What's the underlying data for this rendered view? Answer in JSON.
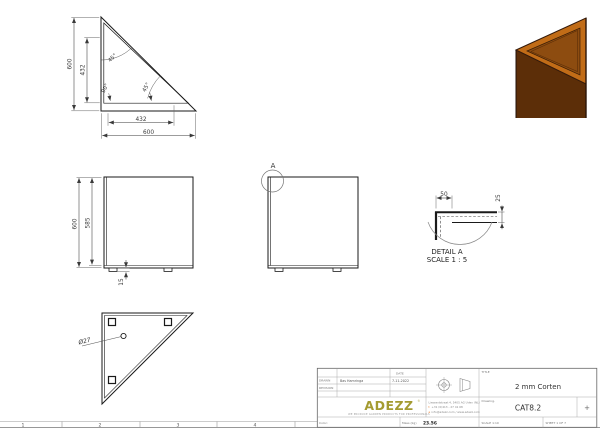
{
  "sheet": {
    "background": "#ffffff",
    "zones": [
      "1",
      "2",
      "3",
      "4"
    ]
  },
  "views": {
    "front": {
      "height": "600",
      "inner_height": "432",
      "inner_width": "432",
      "width": "600",
      "angle_top": "45°",
      "angle_corner": "90°",
      "angle_hyp": "45°"
    },
    "side_a": {
      "height": "600",
      "inner_height": "585",
      "foot_height": "15"
    },
    "side_b": {
      "detail_ref": "A"
    },
    "detail_a": {
      "title": "DETAIL A",
      "scale": "SCALE 1 : 5",
      "flange_width": "50",
      "flange_height": "25"
    },
    "bottom": {
      "hole_diameter": "Ø27"
    }
  },
  "render_3d": {
    "rim_color": "#c16c17",
    "top_color": "#8d4c10",
    "front_color": "#5c2e08",
    "outline_color": "#33190a"
  },
  "title_block": {
    "drawn_label": "DRAWN",
    "drawn_value": "Bas Hamringa",
    "revision_label": "REVISION",
    "date_label": "DATE",
    "date_value": "7-11-2022",
    "title_label": "TITLE",
    "title_value": "2 mm Corten",
    "drawing_label": "Drawing.",
    "drawing_value": "CAT8.2",
    "logo_text": "ADEZZ",
    "logo_color": "#a49b31",
    "logo_mark": "®",
    "tagline": "WE PRODUCE GARDEN PRODUCTS FOR PROFESSIONALS",
    "address_line1": "Liessentstraat 4, 5405 AG Uden (NL)",
    "phone_prefix": "t",
    "phone": "+31 (0)413 - 27 41 68",
    "email_prefix": "e",
    "email": "info@adezz.com / www.adezz.com",
    "color_label": "Color:",
    "mass_label": "Mass (kg)",
    "mass_value": "23.56",
    "scale_label": "SCALE 1:10",
    "sheet_label": "SHEET 1 OF 7",
    "plus_mark": "+"
  }
}
